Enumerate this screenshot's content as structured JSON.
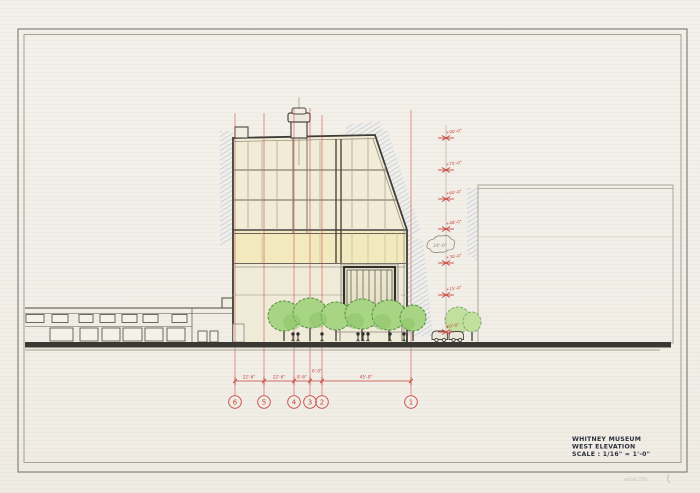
{
  "drawing": {
    "title_block": {
      "project": "WHITNEY MUSEUM",
      "view": "WEST ELEVATION",
      "scale": "SCALE : 1/16\" = 1'-0\""
    },
    "corner_note": "whsk.05k"
  },
  "grid": {
    "bubbles": [
      {
        "label": "6"
      },
      {
        "label": "5"
      },
      {
        "label": "4"
      },
      {
        "label": "3"
      },
      {
        "label": "2"
      },
      {
        "label": "1"
      }
    ],
    "dimensions": [
      {
        "text": "22'-6\""
      },
      {
        "text": "22'-6\""
      },
      {
        "text": "8'-6\""
      },
      {
        "text": "6'-0\""
      },
      {
        "text": "45'-0\""
      }
    ]
  },
  "elevations": {
    "markers": [
      {
        "label": "+90'-0\""
      },
      {
        "label": "+75'-0\""
      },
      {
        "label": "+60'-0\""
      },
      {
        "label": "+48'-0\""
      },
      {
        "label": "+30'-0\""
      },
      {
        "label": "+15'-0\""
      },
      {
        "label": "±0'-0\""
      }
    ]
  },
  "annotations": {
    "cloud_text": "24'-0\""
  },
  "colors": {
    "paper": "#f2efe9",
    "ink": "#3e3c36",
    "grid_red": "#c8473f",
    "hatch_blue": "#7d9fd2",
    "tree_green": "#a8d584",
    "facade_cream": "#f2ebd6",
    "facade_yellow": "#f2e9bb"
  }
}
